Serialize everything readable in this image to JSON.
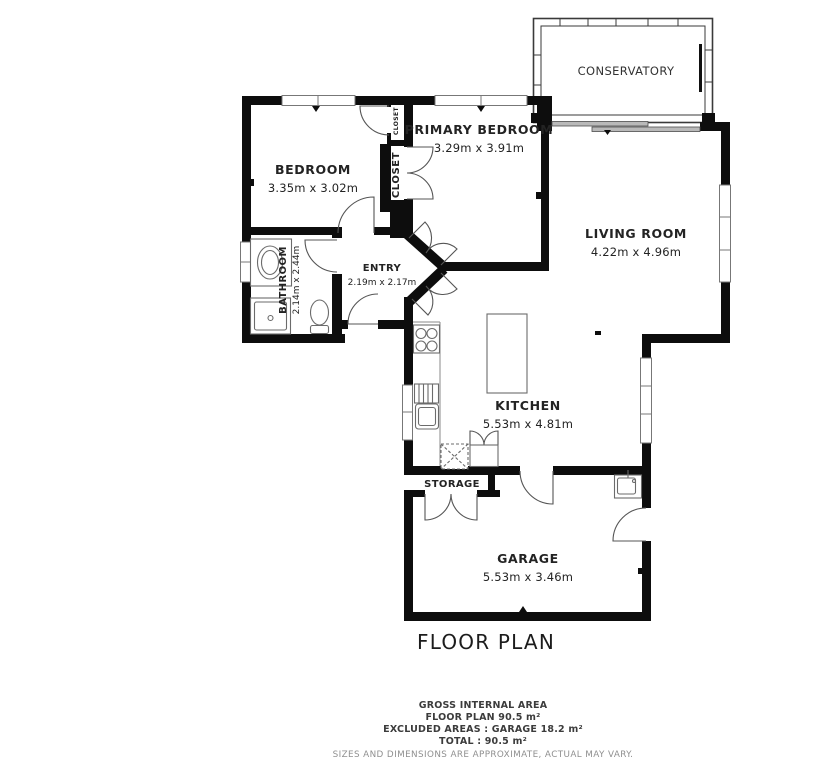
{
  "page": {
    "title": "FLOOR PLAN"
  },
  "rooms": {
    "conservatory": {
      "name": "CONSERVATORY"
    },
    "primary_bedroom": {
      "name": "PRIMARY BEDROOM",
      "dims": "3.29m x 3.91m"
    },
    "bedroom": {
      "name": "BEDROOM",
      "dims": "3.35m x 3.02m"
    },
    "living_room": {
      "name": "LIVING ROOM",
      "dims": "4.22m x 4.96m"
    },
    "entry": {
      "name": "ENTRY",
      "dims": "2.19m x 2.17m"
    },
    "bathroom": {
      "name": "BATHROOM",
      "dims": "2.14m x 2.44m"
    },
    "kitchen": {
      "name": "KITCHEN",
      "dims": "5.53m x 4.81m"
    },
    "garage": {
      "name": "GARAGE",
      "dims": "5.53m x 3.46m"
    },
    "storage": {
      "name": "STORAGE"
    },
    "closet_large": {
      "name": "CLOSET"
    },
    "closet_small": {
      "name": "CLOSET"
    }
  },
  "footer": {
    "line1": "GROSS INTERNAL AREA",
    "line2": "FLOOR PLAN 90.5 m²",
    "line3": "EXCLUDED AREAS :  GARAGE 18.2 m²",
    "line4": "TOTAL :  90.5 m²",
    "disclaimer": "SIZES AND DIMENSIONS ARE APPROXIMATE, ACTUAL MAY VARY."
  },
  "colors": {
    "wall": "#0d0d0d",
    "fixture": "#6b6b6b",
    "door": "#555555",
    "window": "#777777",
    "label": "#232323",
    "muted": "#8f8f8f"
  }
}
